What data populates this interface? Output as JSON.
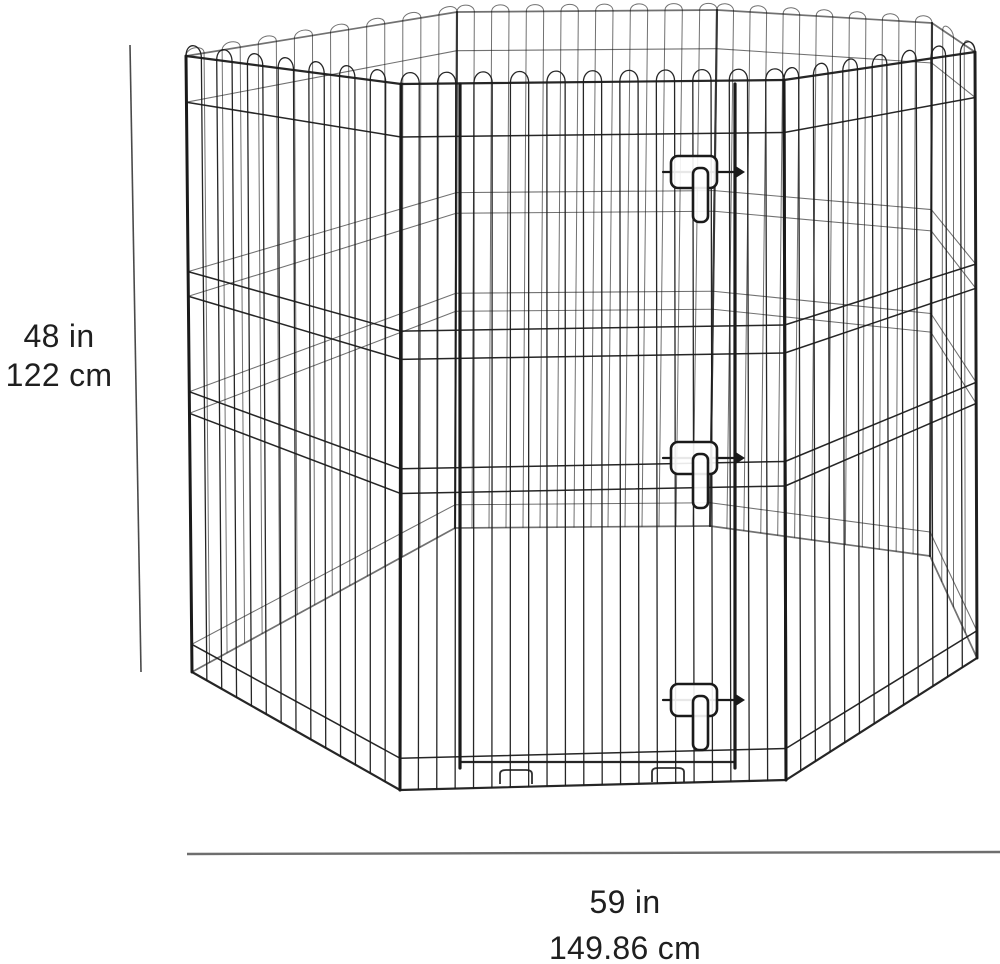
{
  "labels": {
    "height_in": "48 in",
    "height_cm": "122 cm",
    "width_in": "59 in",
    "width_cm": "149.86 cm"
  },
  "styles": {
    "text_color": "#1f1f1f",
    "wire_color": "#1a1a1a",
    "height_line_color": "#4a4a4a",
    "width_line_color": "#6e6e6e",
    "background": "#ffffff"
  },
  "figure": {
    "wire_color": "#1a1a1a",
    "rail_fracs": [
      0.075,
      0.35,
      0.39,
      0.545,
      0.58,
      0.955
    ],
    "panels": [
      {
        "name": "back-left",
        "cls": "back",
        "tl": [
          457,
          12
        ],
        "tr": [
          186,
          56
        ],
        "bl": [
          455,
          528
        ],
        "br": [
          192,
          672
        ],
        "nv": 14
      },
      {
        "name": "back",
        "cls": "back",
        "tl": [
          717,
          10
        ],
        "tr": [
          457,
          12
        ],
        "bl": [
          710,
          526
        ],
        "br": [
          455,
          528
        ],
        "nv": 14
      },
      {
        "name": "back-right",
        "cls": "back",
        "tl": [
          932,
          23
        ],
        "tr": [
          717,
          10
        ],
        "bl": [
          930,
          556
        ],
        "br": [
          710,
          526
        ],
        "nv": 12
      },
      {
        "name": "right-edge",
        "cls": "back",
        "tl": [
          975,
          52
        ],
        "tr": [
          932,
          23
        ],
        "bl": [
          977,
          658
        ],
        "br": [
          930,
          556
        ],
        "nv": 3
      },
      {
        "name": "front-left",
        "cls": "front",
        "tl": [
          186,
          56
        ],
        "tr": [
          401,
          84
        ],
        "bl": [
          192,
          672
        ],
        "br": [
          400,
          790
        ],
        "nv": 13
      },
      {
        "name": "front-right",
        "cls": "front",
        "tl": [
          784,
          80
        ],
        "tr": [
          975,
          52
        ],
        "bl": [
          786,
          780
        ],
        "br": [
          977,
          658
        ],
        "nv": 12
      },
      {
        "name": "front-door",
        "cls": "front",
        "tl": [
          401,
          84
        ],
        "tr": [
          784,
          80
        ],
        "bl": [
          400,
          790
        ],
        "br": [
          786,
          780
        ],
        "nv": 20
      }
    ],
    "door": {
      "left_post_x": 460,
      "right_post_x": 735,
      "top_y": 84,
      "bottom_y": 768,
      "bottom_bar_y": 762
    },
    "latches": [
      {
        "cy": 172
      },
      {
        "cy": 458
      },
      {
        "cy": 700
      }
    ],
    "latch_geom": {
      "rect_x": 671,
      "rect_w": 46,
      "rect_h": 32,
      "rx": 7,
      "tongue_x": 693,
      "tongue_w": 15,
      "tongue_len": 54,
      "bar_x1": 663,
      "bar_x2": 742
    },
    "feet": [
      [
        500,
        770
      ],
      [
        652,
        768
      ]
    ],
    "height_line": {
      "x1": 130,
      "y1": 45,
      "x2": 141,
      "y2": 672
    },
    "width_line": {
      "x1": 187,
      "y1": 854,
      "x2": 1000,
      "y2": 852
    }
  }
}
